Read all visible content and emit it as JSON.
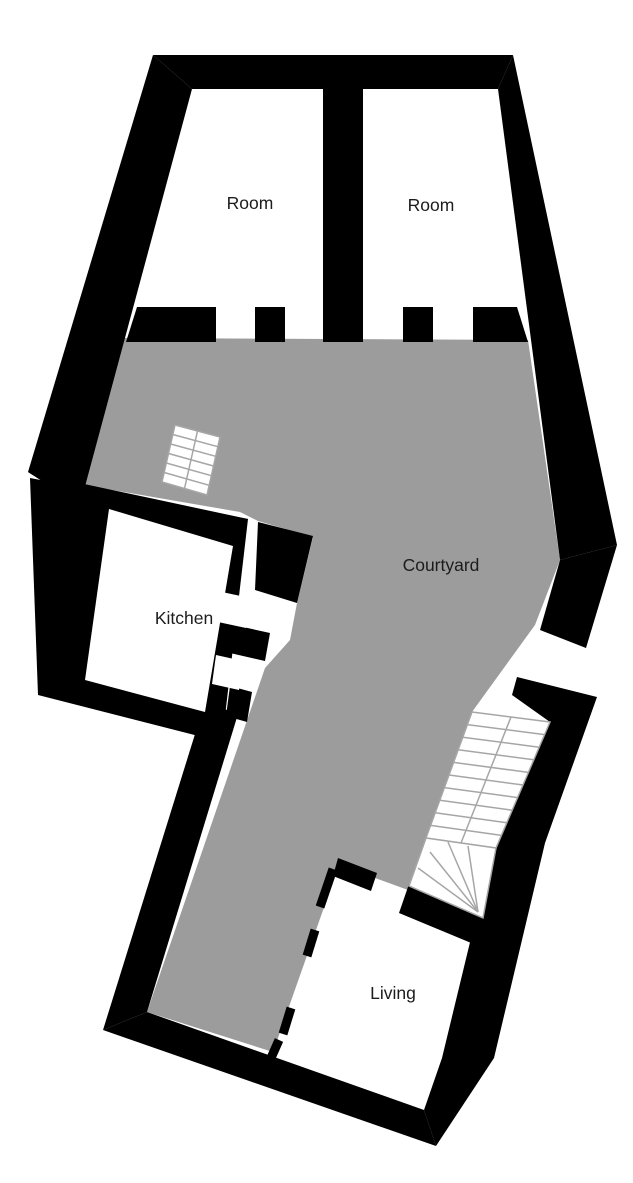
{
  "floor_plan": {
    "labels": {
      "room_1": "Room",
      "room_2": "Room",
      "courtyard": "Courtyard",
      "kitchen": "Kitchen",
      "living": "Living"
    },
    "colors": {
      "wall": "#000000",
      "courtyard_fill": "#9c9c9c",
      "background": "#ffffff",
      "stair_lines": "#a6a6a6",
      "text": "#1c1c1c"
    }
  }
}
